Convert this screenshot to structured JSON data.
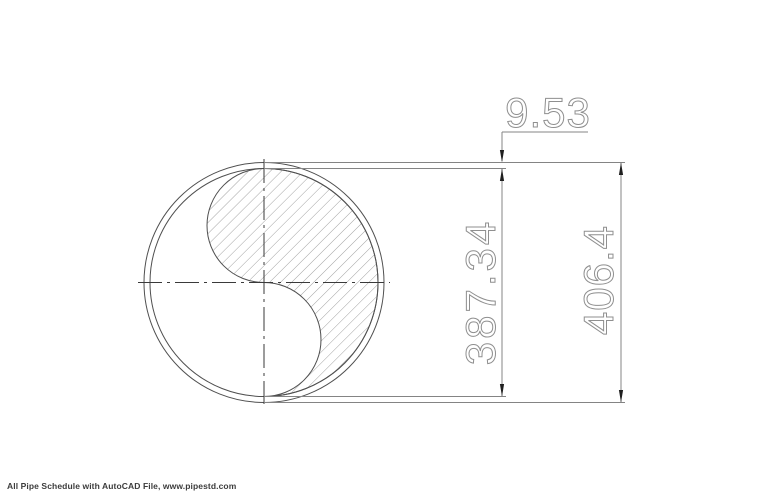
{
  "drawing": {
    "dimensions": {
      "wall_thickness": "9.53",
      "inner_diameter": "387.34",
      "outer_diameter": "406.4"
    },
    "footer": {
      "credit": "All Pipe Schedule with AutoCAD File, www.pipestd.com"
    },
    "colors": {
      "background": "#ffffff",
      "drawing_line": "#4f4f4f",
      "hatch_line": "#8c8c8c",
      "centerline": "#3a3a3a",
      "dimension_line": "#848484",
      "dimension_text": "#8f8f8f",
      "arrow": "#1f1f1f",
      "footer_text": "#3c3c3c"
    }
  }
}
